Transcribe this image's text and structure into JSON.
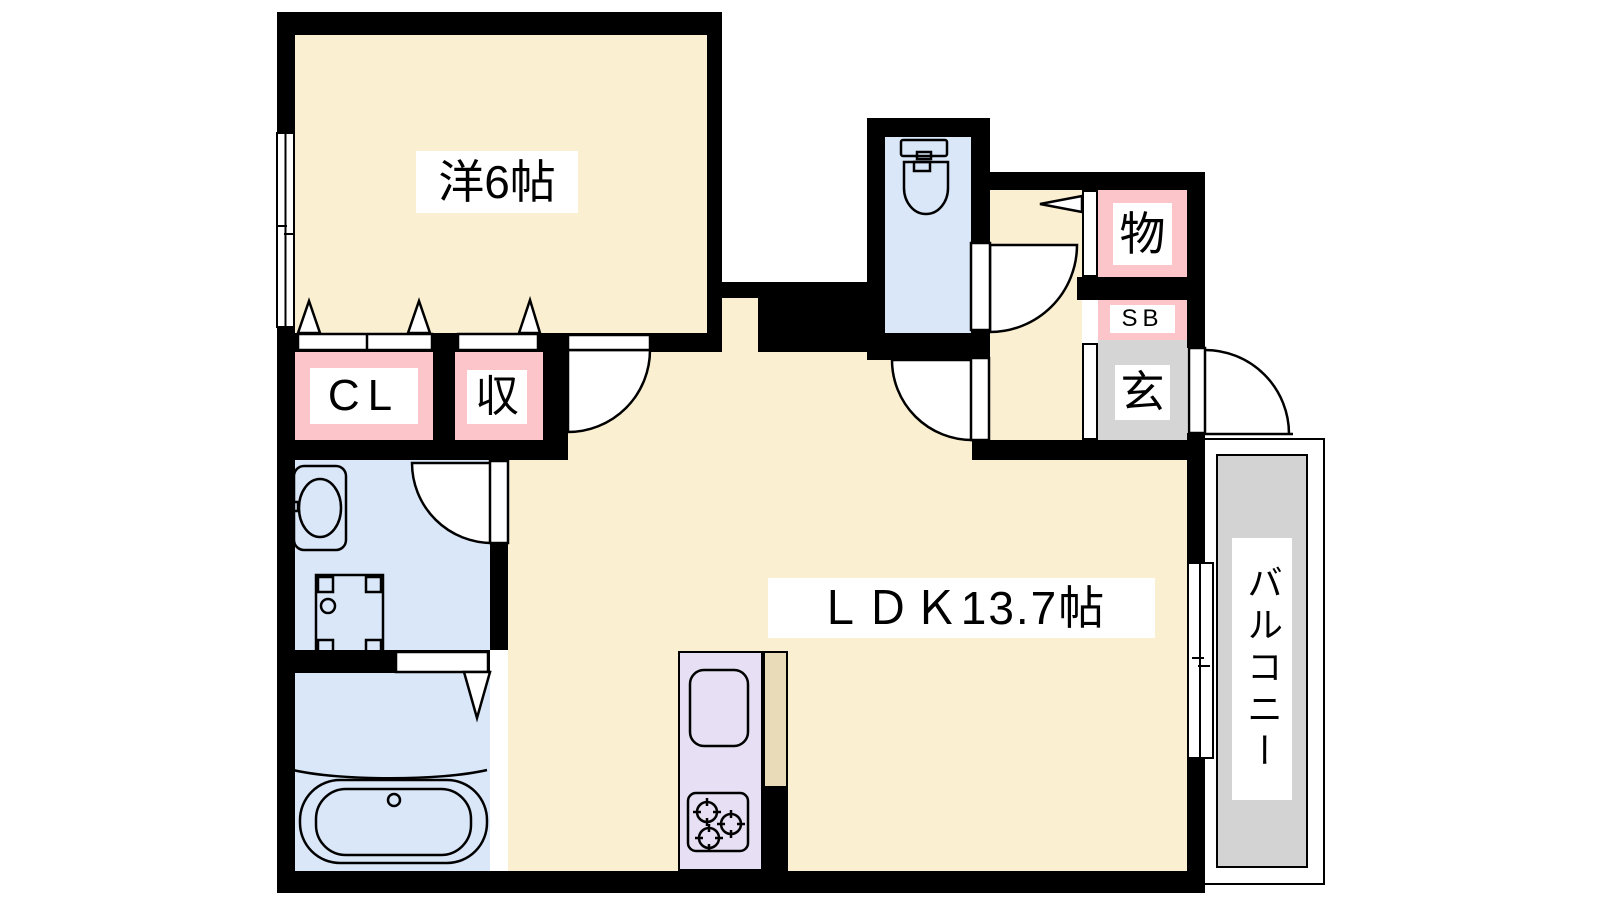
{
  "plan_title": "1LDK apartment floor plan",
  "labels": {
    "bedroom": "洋6帖",
    "closet": "CL",
    "bedroom_storage": "収",
    "ldk": "ＬＤＫ13.7帖",
    "hall_storage": "物",
    "shoe_box": "SB",
    "entrance": "玄",
    "balcony": "バルコニー"
  },
  "colors": {
    "wall": "#000000",
    "floor_cream": "#FAEFD0",
    "storage_pink": "#FBC5C9",
    "wet_area_blue": "#DAE7F8",
    "kitchen_lavender": "#E7DFF3",
    "counter_tan": "#E9DAB8",
    "entrance_gray": "#D5D5D5",
    "balcony_gray": "#D3D3D3",
    "background": "#FFFFFF"
  },
  "fixtures": [
    "toilet-icon",
    "washbasin-icon",
    "washing-machine-pan-icon",
    "bathtub-icon",
    "kitchen-sink-icon",
    "gas-stove-icon",
    "swing-door-icon",
    "sliding-window-icon",
    "folding-door-triangle-icon"
  ]
}
